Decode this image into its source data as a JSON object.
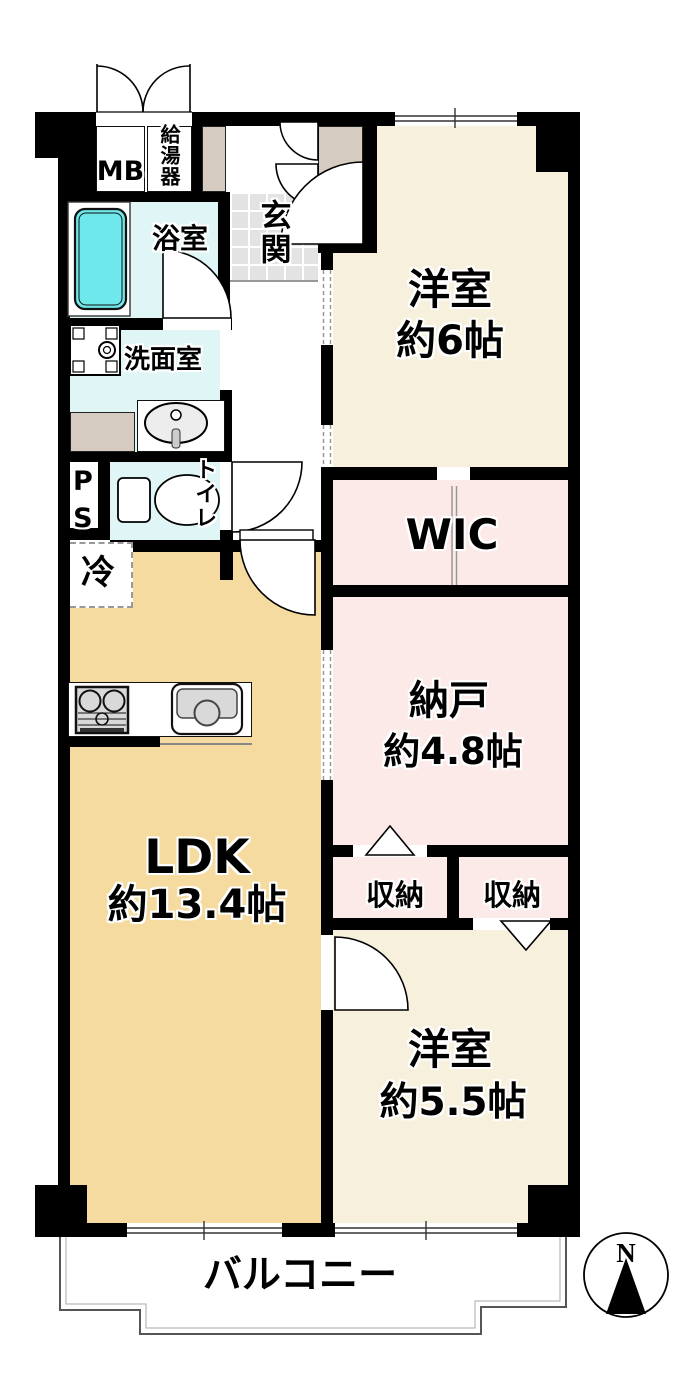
{
  "floorplan": {
    "rooms": {
      "mb": {
        "label": "MB"
      },
      "water_heater": {
        "label": "給湯器"
      },
      "entrance": {
        "label": "玄関"
      },
      "bathroom": {
        "label": "浴室"
      },
      "washroom": {
        "label": "洗面室"
      },
      "pipe_space": {
        "label": "PS"
      },
      "toilet": {
        "label": "トイレ"
      },
      "refrigerator_space": {
        "label": "冷"
      },
      "ldk": {
        "name": "LDK",
        "size": "約13.4帖"
      },
      "western_room_6": {
        "name": "洋室",
        "size": "約6帖"
      },
      "wic": {
        "label": "WIC"
      },
      "storage_room": {
        "name": "納戸",
        "size": "約4.8帖"
      },
      "closet_a": {
        "label": "収納"
      },
      "closet_b": {
        "label": "収納"
      },
      "western_room_55": {
        "name": "洋室",
        "size": "約5.5帖"
      },
      "balcony": {
        "label": "バルコニー"
      }
    },
    "compass": {
      "north_label": "N"
    },
    "colors": {
      "wall": "#000000",
      "western_room_floor": "#F6F0DC",
      "ldk_floor": "#F5DBA0",
      "storage_floor": "#FCEAE8",
      "wet_area_floor": "#DFF5F6",
      "bathtub": "#6FE8EC",
      "entrance_tile": "#E3E3E3",
      "cabinet": "#D5CBC0"
    }
  }
}
